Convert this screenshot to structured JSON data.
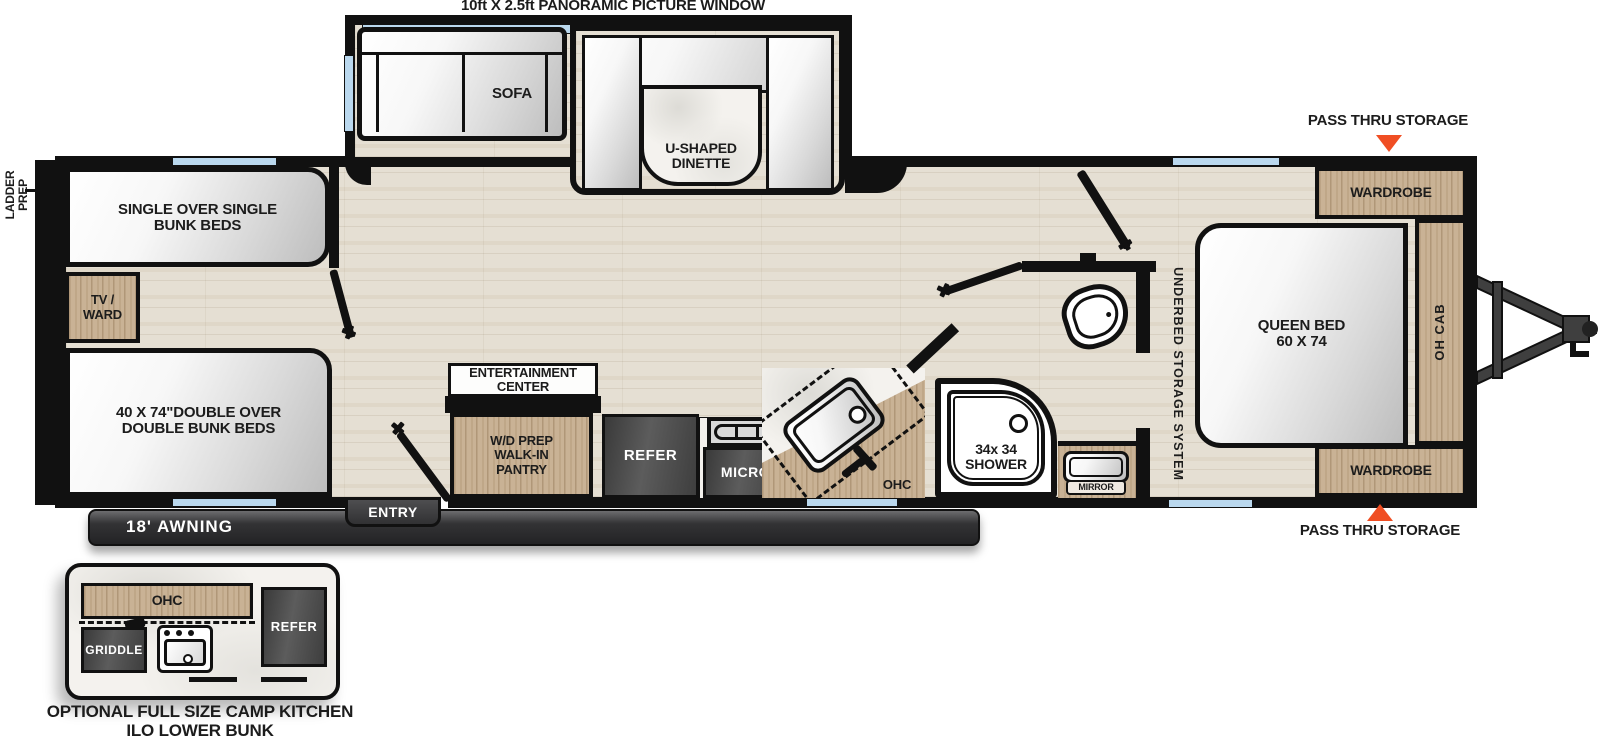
{
  "colors": {
    "accent_orange": "#F04E23",
    "window_blue": "#BAD8EE",
    "wood_tan": "#C9B295",
    "appliance_dark": "#474747",
    "wall_black": "#111111",
    "floor_beige": "#E5DFD3"
  },
  "exterior": {
    "panoramic_window": "10ft X 2.5ft PANORAMIC PICTURE WINDOW",
    "ladder_prep": "LADDER\nPREP",
    "awning": "18' AWNING",
    "entry": "ENTRY",
    "pass_thru_storage_top": "PASS THRU STORAGE",
    "pass_thru_storage_bottom": "PASS THRU STORAGE"
  },
  "living": {
    "sofa": "SOFA",
    "dinette": "U-SHAPED\nDINETTE",
    "entertainment_center": "ENTERTAINMENT\nCENTER"
  },
  "bunks": {
    "single": "SINGLE OVER SINGLE\nBUNK BEDS",
    "tv_ward": "TV /\nWARD",
    "double": "40 X 74\"DOUBLE OVER\nDOUBLE BUNK BEDS"
  },
  "kitchen": {
    "pantry": "W/D PREP\nWALK-IN\nPANTRY",
    "refer": "REFER",
    "micro": "MICRO",
    "ohc": "OHC"
  },
  "bath": {
    "shower": "34x 34\nSHOWER",
    "mirror": "MIRROR"
  },
  "bedroom": {
    "underbed": "UNDERBED STORAGE SYSTEM",
    "queen_bed": "QUEEN BED\n60 X 74",
    "wardrobe_top": "WARDROBE",
    "wardrobe_bottom": "WARDROBE",
    "oh_cab": "OH CAB"
  },
  "inset": {
    "ohc": "OHC",
    "griddle": "GRIDDLE",
    "refer": "REFER",
    "caption": "OPTIONAL FULL SIZE CAMP KITCHEN\nILO LOWER BUNK"
  }
}
